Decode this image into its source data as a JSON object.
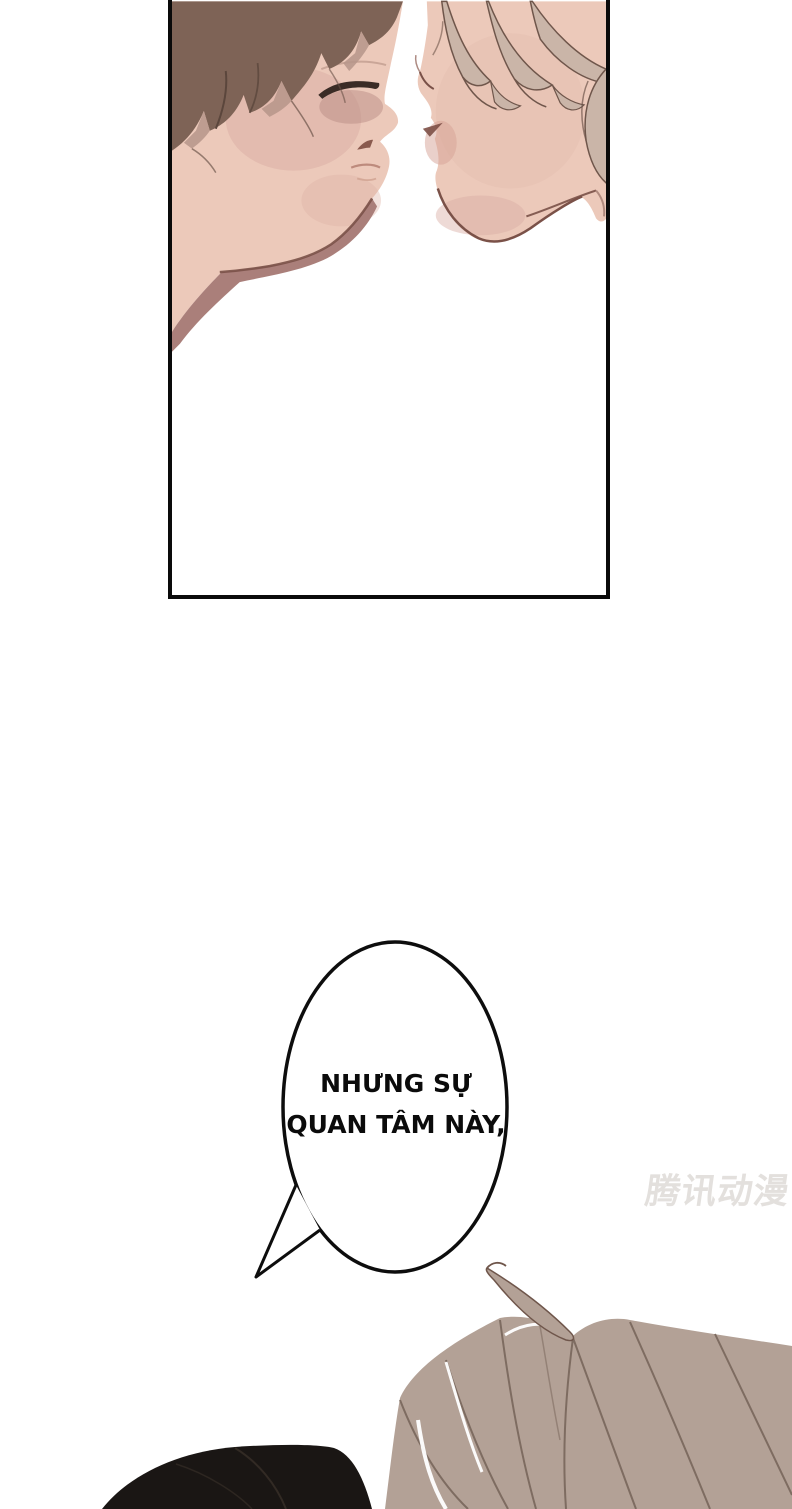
{
  "dialogue": {
    "full_text": "NHƯNG SỰ QUAN TÂM NÀY,",
    "lines": [
      "NHƯNG SỰ",
      "QUAN TÂM NÀY,"
    ]
  },
  "watermark": {
    "text": "腾讯动漫"
  },
  "palette": {
    "panel_border": "#0a0a0a",
    "skin": "#ecc9ba",
    "cheek_shading": "#d9aea3",
    "neck_shadow": "#aa7f7a",
    "line_brown": "#7a5148",
    "left_hair": "#7e6356",
    "left_hair_light": "#b6958a",
    "right_hair": "#cab5a8",
    "right_hair_line": "#6f564b",
    "bottom_hair_taupe": "#b3a196",
    "bottom_hair_line": "#7e6c61",
    "black_hair": "#1a1614",
    "bubble_stroke": "#0d0d0d",
    "watermark_gray": "#e3e0dd"
  }
}
